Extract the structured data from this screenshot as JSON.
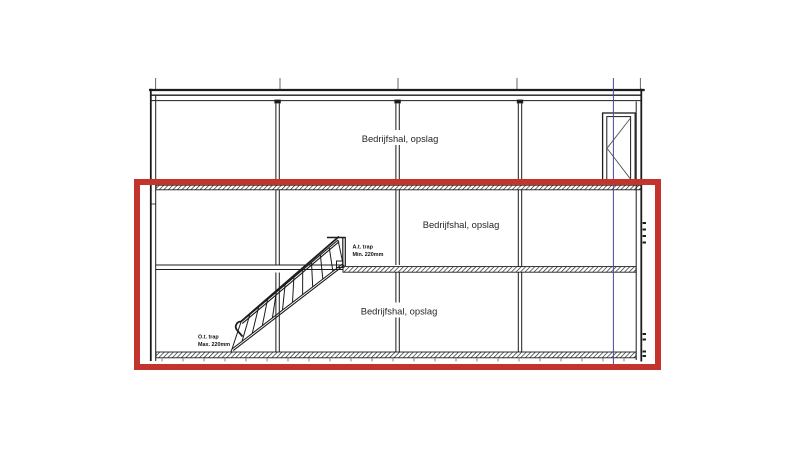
{
  "drawing": {
    "floor_labels": {
      "top": "Bedrijfshal, opslag",
      "middle": "Bedrijfshal, opslag",
      "bottom": "Bedrijfshal, opslag"
    },
    "stair_annotations": {
      "upper": {
        "line1": "A.t. trap",
        "line2": "Min. 220mm"
      },
      "lower": {
        "line1": "O.t. trap",
        "line2": "Max. 220mm"
      }
    },
    "colors": {
      "highlight_red": "#c2342c",
      "grid_blue": "#4348a8",
      "ink": "#1c1c1c"
    }
  }
}
